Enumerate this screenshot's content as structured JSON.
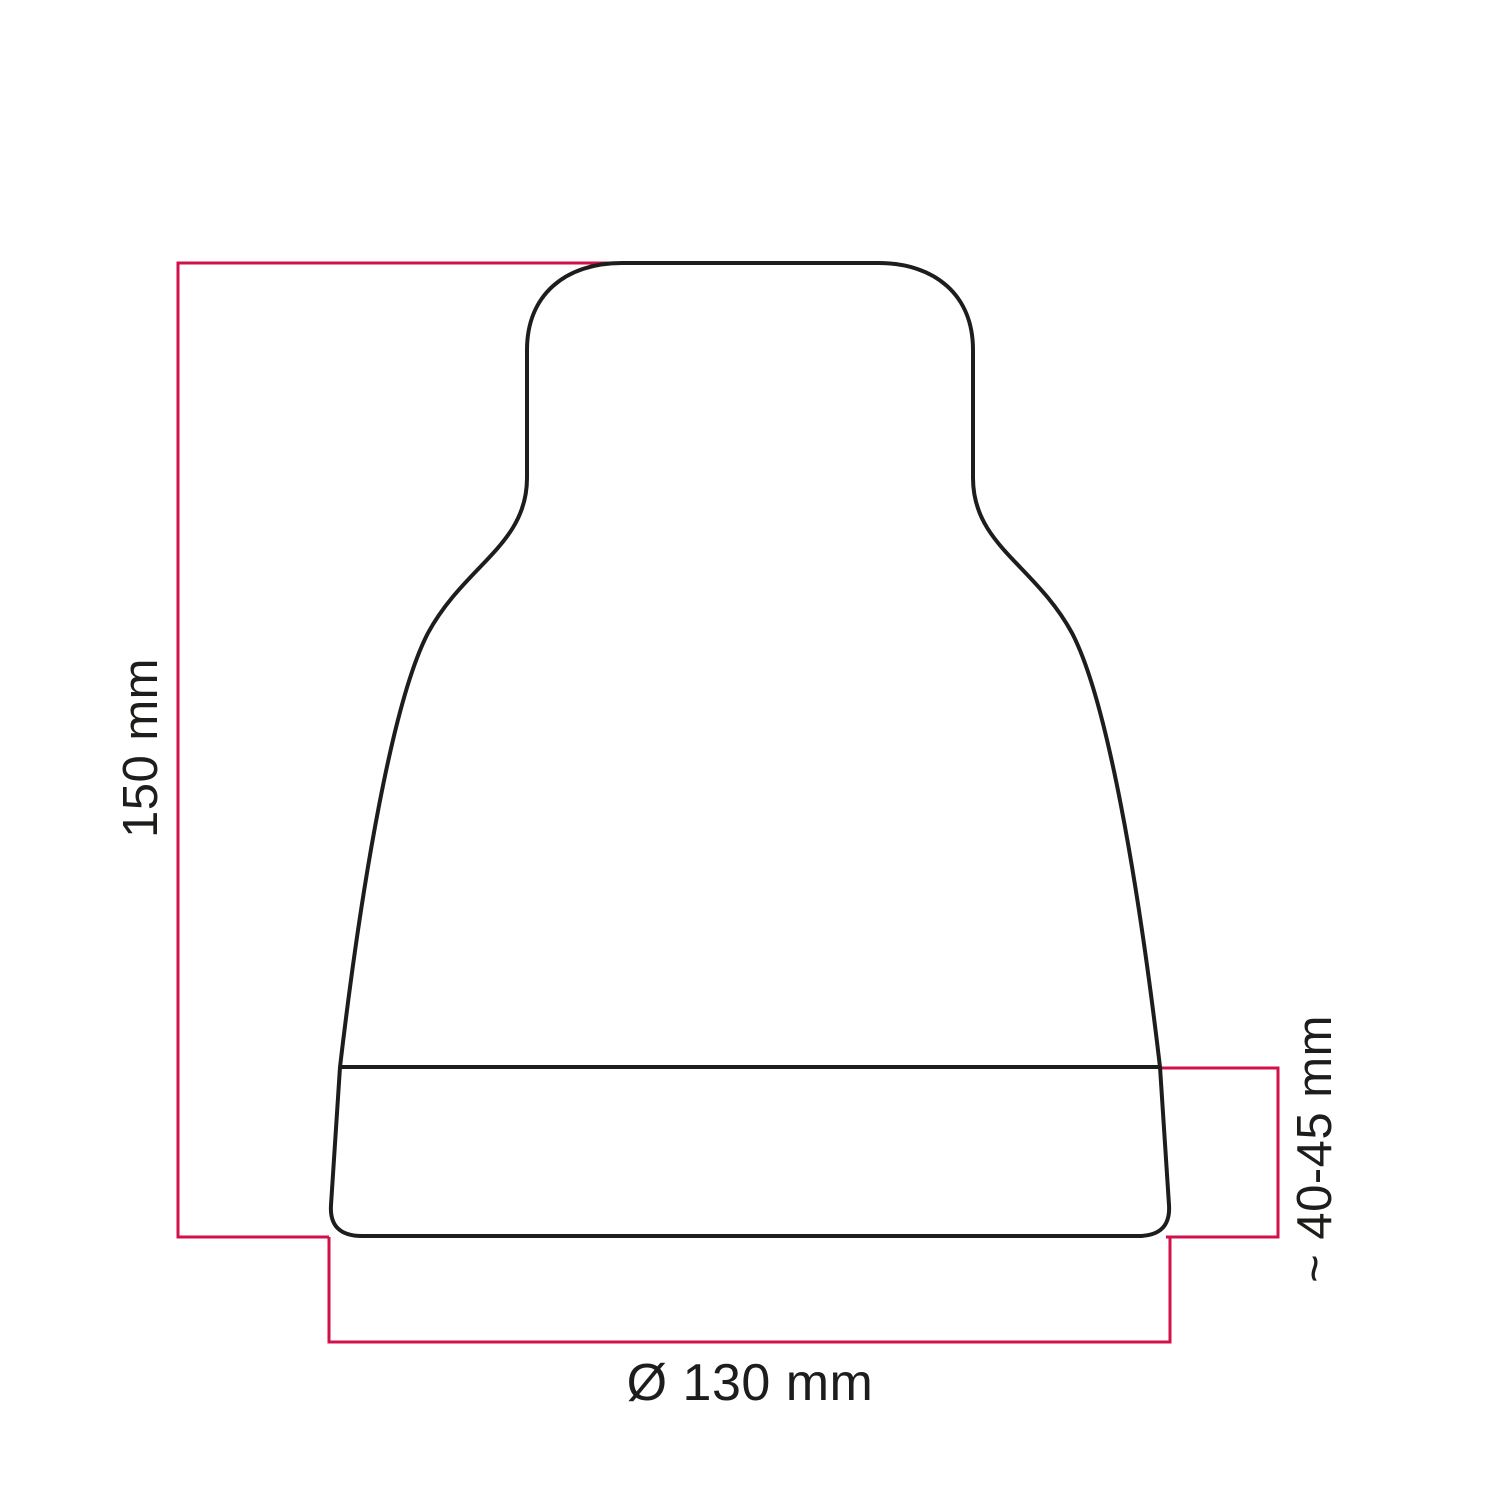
{
  "diagram": {
    "type": "technical-dimension-drawing",
    "subject": "vase-shaped lamp holder cover, front elevation with dimension lines",
    "colors": {
      "outline": "#1d1d1b",
      "dimension": "#d2104a",
      "text": "#1d1d1b",
      "background": "#ffffff"
    },
    "dimensions": {
      "height": {
        "label": "150 mm",
        "value_mm": 150,
        "orientation": "vertical",
        "position": "left"
      },
      "base_height": {
        "label": "~ 40-45 mm",
        "value_mm": "40-45",
        "approximate": true,
        "orientation": "vertical",
        "position": "right"
      },
      "base_diameter": {
        "label": "Ø 130 mm",
        "value_mm": 130,
        "orientation": "horizontal",
        "position": "bottom"
      }
    }
  }
}
